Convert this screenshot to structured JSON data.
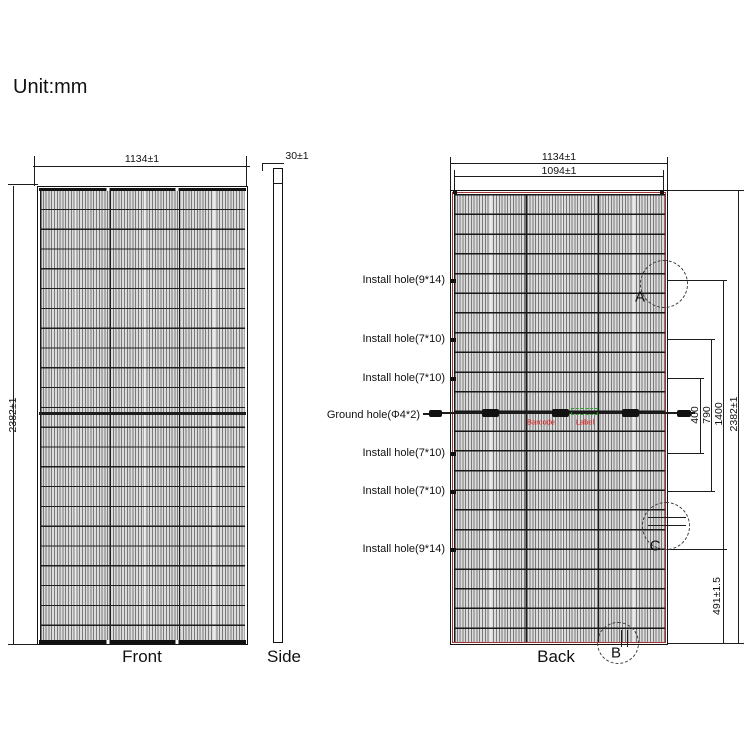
{
  "title": "Unit:mm",
  "front": {
    "caption": "Front",
    "width_dim": "1134±1",
    "height_dim": "2382±1"
  },
  "side": {
    "caption": "Side",
    "thickness_dim": "30±1"
  },
  "back": {
    "caption": "Back",
    "width_dim": "1134±1",
    "inner_width_dim": "1094±1",
    "height_dim": "2382±1",
    "pitch_inner_dim": "400",
    "pitch_mid_dim": "790",
    "pitch_outer_dim": "1400",
    "bottom_offset_dim": "491±1.5",
    "hole_labels": [
      "Install hole(9*14)",
      "Install hole(7*10)",
      "Install hole(7*10)",
      "Ground hole(Φ4*2)",
      "Install hole(7*10)",
      "Install hole(7*10)",
      "Install hole(9*14)"
    ],
    "cable_texts": {
      "barcode": "Barcode",
      "label": "Label"
    },
    "details": {
      "a": "A",
      "b": "B",
      "c": "C"
    }
  },
  "colors": {
    "line": "#1c1c1c",
    "frame_red": "#a23434",
    "text_red": "#dd1515",
    "label_green": "#2f9e2f",
    "cell_fill": "#dcdcdc"
  }
}
